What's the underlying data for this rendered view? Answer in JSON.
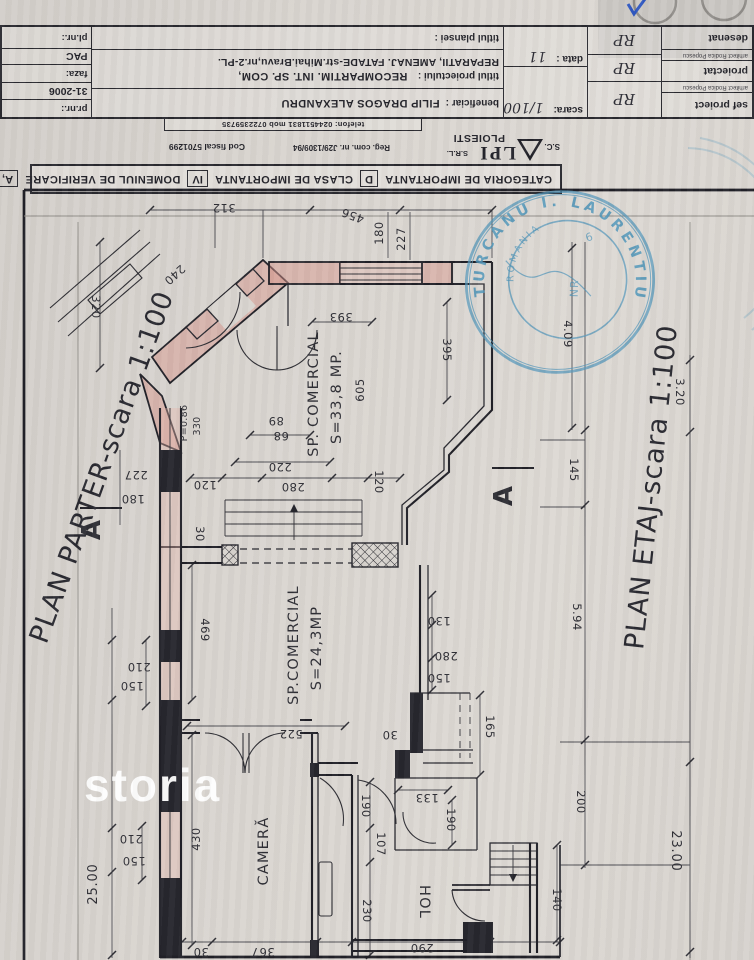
{
  "colors": {
    "paper": "#d6d2cd",
    "ink": "#23232a",
    "wall_pink": "#d5948a",
    "stamp_blue": "#4b93b8"
  },
  "watermark": {
    "text": "storia"
  },
  "title_block": {
    "cat_label": "CATEGORIA DE IMPORTANTA",
    "cat_value": "D",
    "clasa_label": "CLASA DE IMPORTANTA",
    "clasa_value": "IV",
    "dom_label": "DOMENIUL DE VERIFICARE",
    "dom_value": "A,",
    "firm_sc": "S.C.",
    "firm_name": "LPI",
    "firm_srl": "S.R.L.",
    "firm_city": "PLOIESTI",
    "reg_com": "Reg. com. nr. J29/1309/94",
    "cod_fiscal": "Cod fiscal 5701299",
    "telefon": "telefon: 0244511831 mob 0722359735",
    "roles": [
      {
        "t": "sef proiect",
        "small": false
      },
      {
        "t": "arhitect Rodica Popescu",
        "small": true
      },
      {
        "t": "proiectat",
        "small": false
      },
      {
        "t": "arhitect Rodica Popescu",
        "small": true
      },
      {
        "t": "desenat",
        "small": false
      }
    ],
    "signatures": [
      "RP",
      "RP",
      "RP"
    ],
    "scara_label": "scara:",
    "scara_value": "1/100",
    "data_label": "data :",
    "data_value": "11",
    "beneficiar_label": "beneficiar :",
    "beneficiar_value": "FILIP DRAGOS ALEXANDRU",
    "proiect_label": "titlul proiectului :",
    "proiect_value_1": "RECOMPARTIM. INT. SP. COM,",
    "proiect_value_2": "REPARATII, AMENAJ. FATADE-str.Mihai.Bravu,nr.2-PL.",
    "plansa_label": "titlul plansei :",
    "pr_nr_label": "pr.nr.:",
    "pr_nr_value": "31-2006",
    "faza_label": "faza:",
    "faza_value": "PAC",
    "pl_nr_label": "pl.nr.:"
  },
  "stamp": {
    "outer_text": "TURCANU I. LAURENTIU",
    "inner_text": "ROMANIA",
    "center_text": "NR",
    "number": "6"
  },
  "plan": {
    "parter_title": "PLAN PARTER-scara 1:100",
    "etaj_title": "PLAN ETAJ-scara 1:100",
    "texts": [
      {
        "t": "PLAN PARTER-scara 1:100",
        "x": 110,
        "y": 470,
        "r": -70,
        "c": "title",
        "n": "plan-parter-title"
      },
      {
        "t": "PLAN ETAJ-scara 1:100",
        "x": 660,
        "y": 488,
        "r": -84,
        "c": "title",
        "n": "plan-etaj-title"
      },
      {
        "t": "SP. COMERCIAL",
        "x": 318,
        "y": 394,
        "r": -90,
        "c": "room",
        "n": "room-label"
      },
      {
        "t": "S=33,8 MP.",
        "x": 341,
        "y": 397,
        "r": -90,
        "c": "room",
        "n": "room-label"
      },
      {
        "t": "SP.COMERCIAL",
        "x": 298,
        "y": 645,
        "r": -90,
        "c": "room",
        "n": "room-label"
      },
      {
        "t": "S=24,3MP",
        "x": 321,
        "y": 648,
        "r": -90,
        "c": "room",
        "n": "room-label"
      },
      {
        "t": "CAMERĂ",
        "x": 268,
        "y": 851,
        "r": -90,
        "c": "room",
        "n": "room-label"
      },
      {
        "t": "HOL",
        "x": 420,
        "y": 902,
        "r": 90,
        "c": "room",
        "n": "room-label"
      },
      {
        "t": "A",
        "x": 100,
        "y": 530,
        "r": -90,
        "c": "marker",
        "n": "section-marker"
      },
      {
        "t": "A",
        "x": 512,
        "y": 496,
        "r": -90,
        "c": "marker",
        "n": "section-marker"
      },
      {
        "t": "312",
        "x": 224,
        "y": 204,
        "r": 180,
        "c": "dim"
      },
      {
        "t": "456",
        "x": 354,
        "y": 212,
        "r": 200,
        "c": "dim"
      },
      {
        "t": "180",
        "x": 383,
        "y": 233,
        "r": -90,
        "c": "dim"
      },
      {
        "t": "227",
        "x": 405,
        "y": 239,
        "r": -90,
        "c": "dim"
      },
      {
        "t": "240",
        "x": 172,
        "y": 272,
        "r": 138,
        "c": "dim"
      },
      {
        "t": "320",
        "x": 92,
        "y": 307,
        "r": 90,
        "c": "dim"
      },
      {
        "t": "393",
        "x": 341,
        "y": 313,
        "r": 180,
        "c": "dim"
      },
      {
        "t": "395",
        "x": 443,
        "y": 350,
        "r": 90,
        "c": "dim"
      },
      {
        "t": "605",
        "x": 364,
        "y": 390,
        "r": -90,
        "c": "dim"
      },
      {
        "t": "89",
        "x": 276,
        "y": 417,
        "r": 180,
        "c": "dim"
      },
      {
        "t": "68",
        "x": 281,
        "y": 432,
        "r": 180,
        "c": "dim"
      },
      {
        "t": "P=0.86",
        "x": 187,
        "y": 423,
        "r": -90,
        "c": "dims"
      },
      {
        "t": "330",
        "x": 200,
        "y": 426,
        "r": -90,
        "c": "dims"
      },
      {
        "t": "227",
        "x": 136,
        "y": 471,
        "r": 180,
        "c": "dim"
      },
      {
        "t": "180",
        "x": 133,
        "y": 495,
        "r": 180,
        "c": "dim"
      },
      {
        "t": "120",
        "x": 205,
        "y": 481,
        "r": 180,
        "c": "dim"
      },
      {
        "t": "220",
        "x": 280,
        "y": 463,
        "r": 180,
        "c": "dim"
      },
      {
        "t": "280",
        "x": 293,
        "y": 483,
        "r": 180,
        "c": "dim"
      },
      {
        "t": "120",
        "x": 375,
        "y": 482,
        "r": 90,
        "c": "dim"
      },
      {
        "t": "30",
        "x": 196,
        "y": 534,
        "r": 90,
        "c": "dim"
      },
      {
        "t": "4.09",
        "x": 564,
        "y": 334,
        "r": 90,
        "c": "dim"
      },
      {
        "t": "145",
        "x": 570,
        "y": 470,
        "r": 90,
        "c": "dim"
      },
      {
        "t": "3.20",
        "x": 676,
        "y": 392,
        "r": 90,
        "c": "dim"
      },
      {
        "t": "469",
        "x": 201,
        "y": 630,
        "r": 90,
        "c": "dim"
      },
      {
        "t": "130",
        "x": 439,
        "y": 617,
        "r": 180,
        "c": "dim"
      },
      {
        "t": "280",
        "x": 446,
        "y": 652,
        "r": 180,
        "c": "dim"
      },
      {
        "t": "150",
        "x": 439,
        "y": 674,
        "r": 180,
        "c": "dim"
      },
      {
        "t": "210",
        "x": 139,
        "y": 663,
        "r": 180,
        "c": "dim"
      },
      {
        "t": "150",
        "x": 132,
        "y": 682,
        "r": 180,
        "c": "dim"
      },
      {
        "t": "5.94",
        "x": 573,
        "y": 617,
        "r": 90,
        "c": "dim"
      },
      {
        "t": "522",
        "x": 291,
        "y": 730,
        "r": 180,
        "c": "dim"
      },
      {
        "t": "30",
        "x": 390,
        "y": 731,
        "r": 180,
        "c": "dim"
      },
      {
        "t": "165",
        "x": 486,
        "y": 727,
        "r": 90,
        "c": "dim"
      },
      {
        "t": "133",
        "x": 427,
        "y": 794,
        "r": 180,
        "c": "dim"
      },
      {
        "t": "190",
        "x": 447,
        "y": 820,
        "r": 90,
        "c": "dim"
      },
      {
        "t": "190",
        "x": 362,
        "y": 806,
        "r": 90,
        "c": "dim"
      },
      {
        "t": "107",
        "x": 377,
        "y": 844,
        "r": 90,
        "c": "dim"
      },
      {
        "t": "230",
        "x": 363,
        "y": 911,
        "r": 90,
        "c": "dim"
      },
      {
        "t": "430",
        "x": 200,
        "y": 839,
        "r": -90,
        "c": "dim"
      },
      {
        "t": "210",
        "x": 131,
        "y": 835,
        "r": 180,
        "c": "dim"
      },
      {
        "t": "150",
        "x": 134,
        "y": 857,
        "r": 180,
        "c": "dim"
      },
      {
        "t": "25.00",
        "x": 97,
        "y": 884,
        "r": -90,
        "c": "dimbig"
      },
      {
        "t": "200",
        "x": 577,
        "y": 802,
        "r": 90,
        "c": "dim"
      },
      {
        "t": "140",
        "x": 553,
        "y": 900,
        "r": 90,
        "c": "dim"
      },
      {
        "t": "23.00",
        "x": 672,
        "y": 851,
        "r": 90,
        "c": "dimbig"
      },
      {
        "t": "367",
        "x": 263,
        "y": 948,
        "r": 180,
        "c": "dim"
      },
      {
        "t": "30",
        "x": 201,
        "y": 948,
        "r": 180,
        "c": "dim"
      },
      {
        "t": "290",
        "x": 422,
        "y": 944,
        "r": 180,
        "c": "dim"
      }
    ]
  }
}
